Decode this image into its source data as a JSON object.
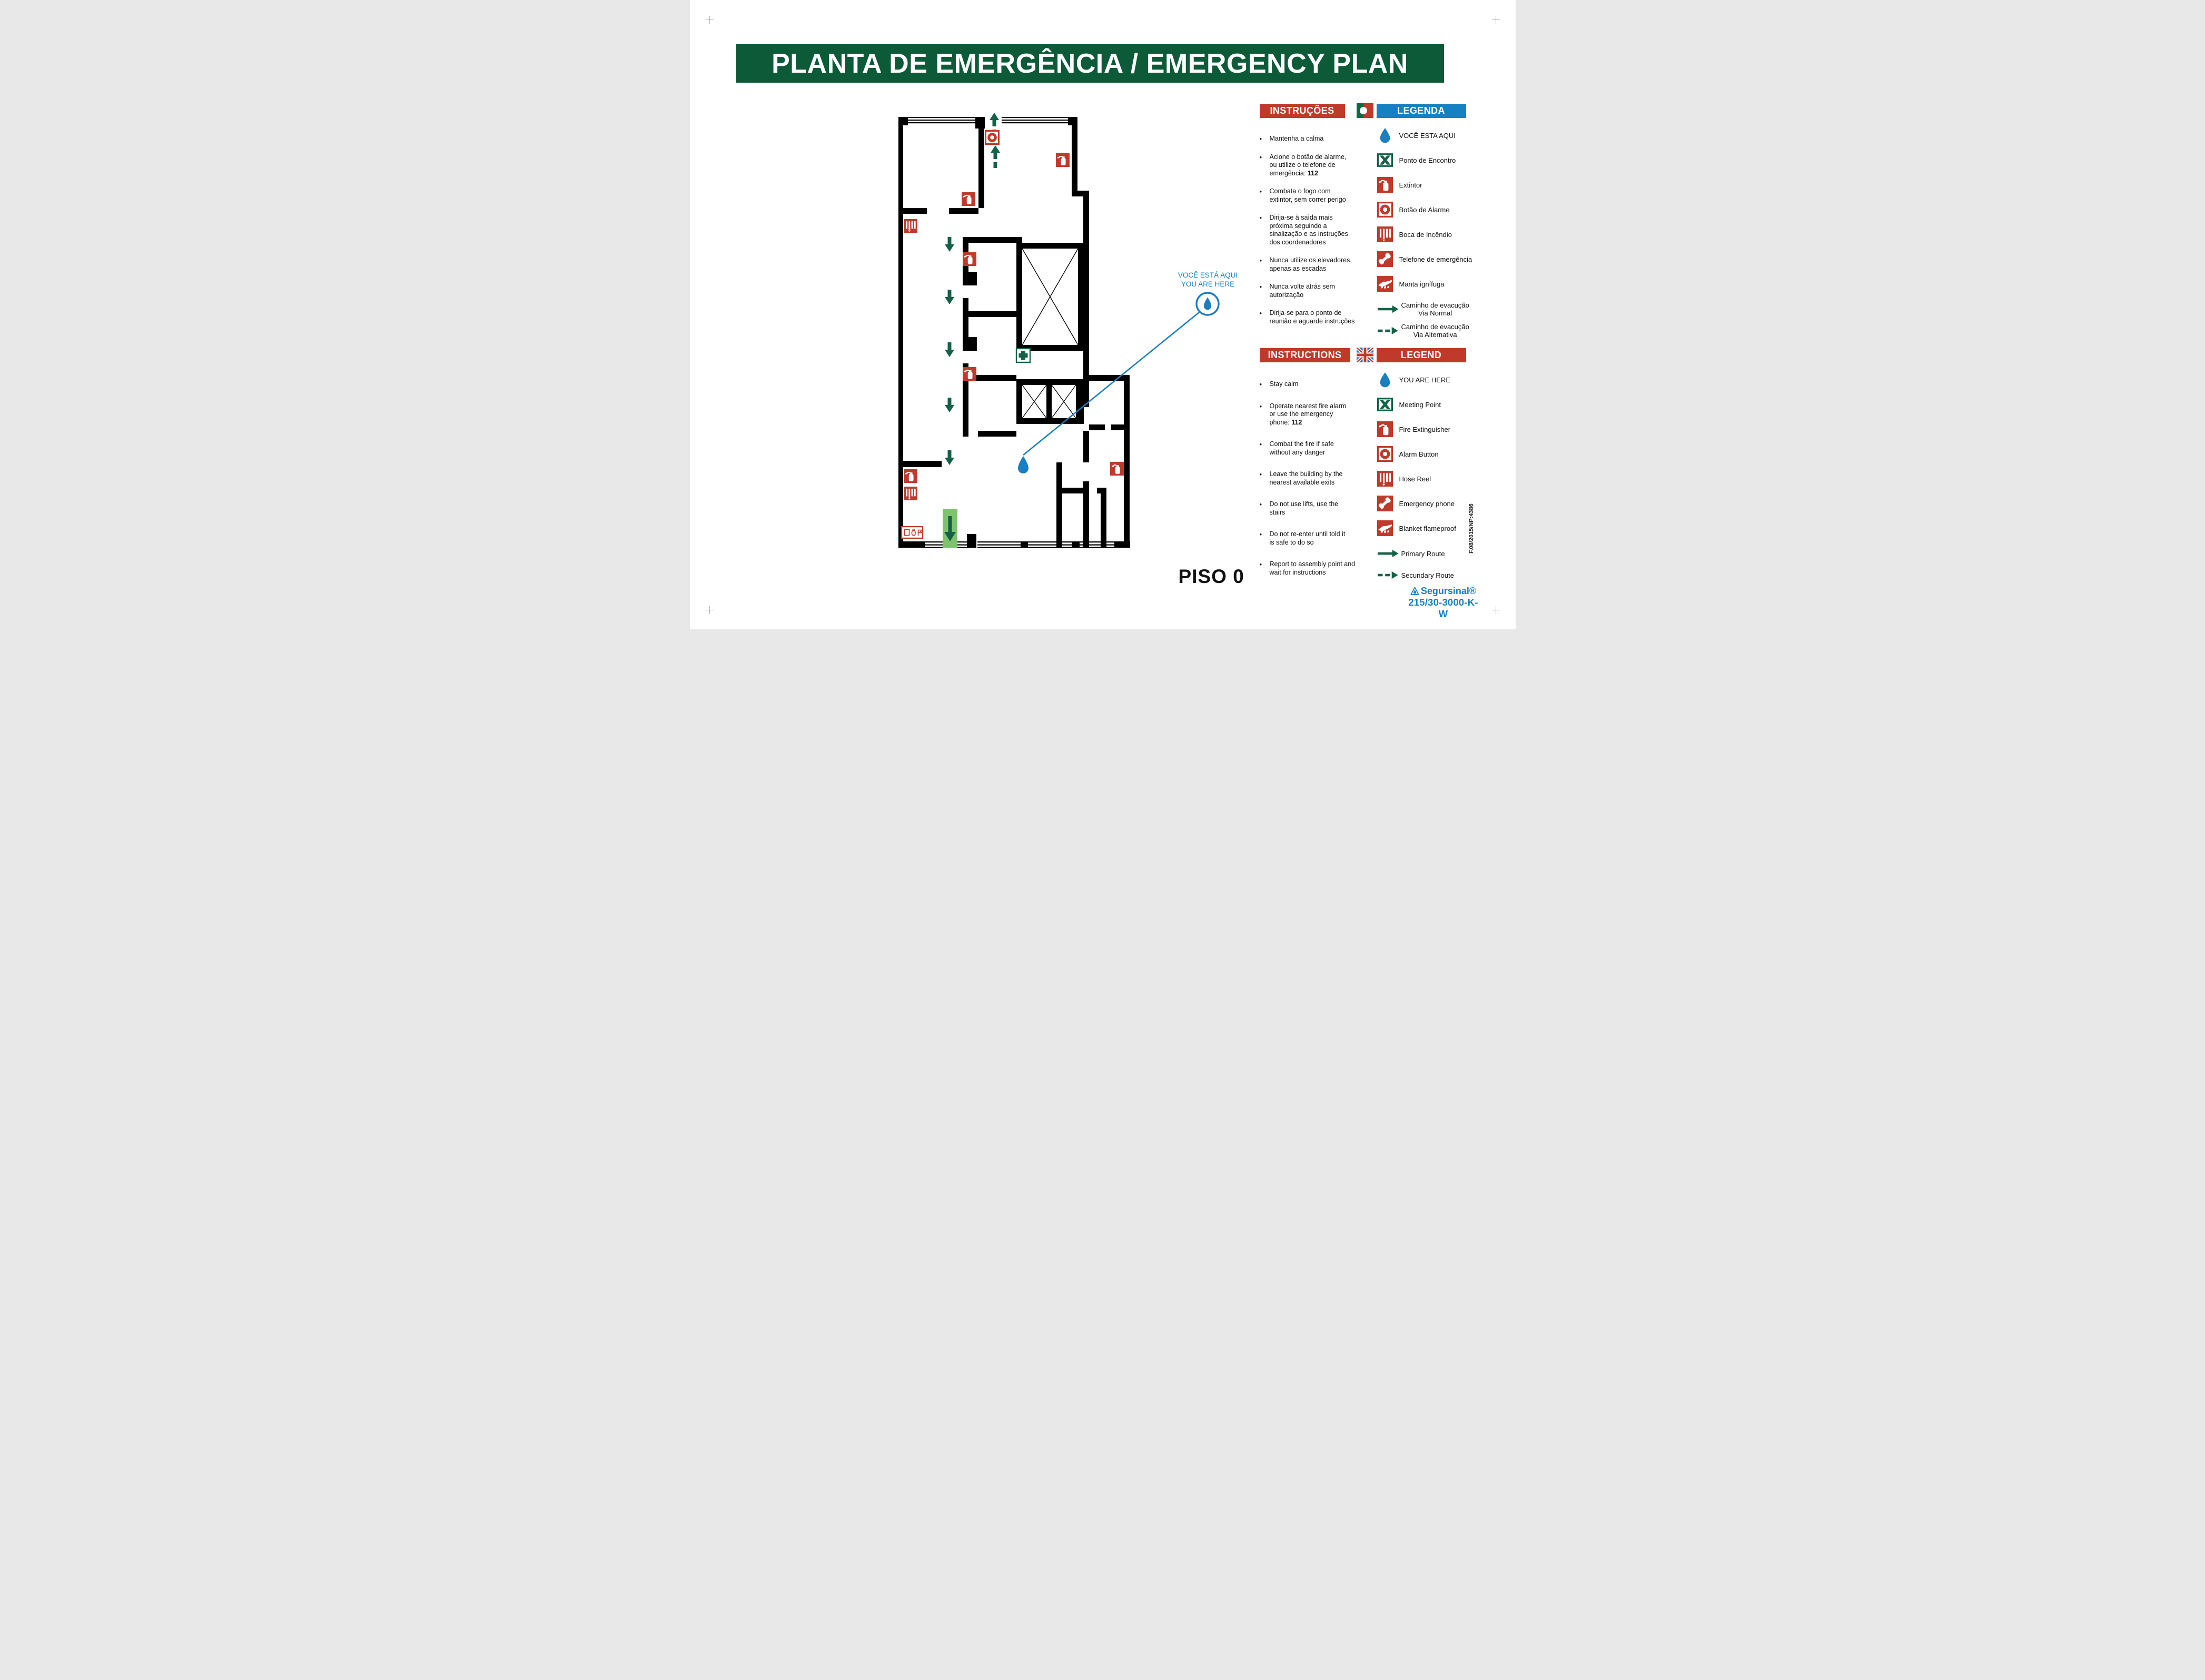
{
  "title": "PLANTA DE EMERGÊNCIA / EMERGENCY PLAN",
  "floor_label": "PISO 0",
  "callout": {
    "line1": "VOCÊ ESTÁ AQUI",
    "line2": "YOU ARE HERE"
  },
  "instructions_pt": {
    "header": "INSTRUÇÕES",
    "items": [
      "Mantenha a calma",
      "Acione o botão de alarme,\nou utilize o telefone de\nemergência: **112**",
      "Combata o fogo com\nextintor, sem correr perigo",
      "Dirija-se à saìda mais\npróxima seguindo a\nsinalização e as instruções\ndos coordenadores",
      "Nunca utilize os elevadores,\napenas as escadas",
      "Nunca volte atrás sem\nautorização",
      "Dirija-se para o ponto de\nreunião e aguarde instruções"
    ]
  },
  "legend_pt": {
    "header": "LEGENDA",
    "items": [
      {
        "icon": "icon-drop",
        "name": "you-are-here-drop-icon",
        "label": "VOCÊ ESTA AQUI"
      },
      {
        "icon": "icon-meeting",
        "name": "meeting-point-icon",
        "label": "Ponto de Encontro"
      },
      {
        "icon": "icon-ext",
        "name": "fire-extinguisher-icon",
        "label": "Extintor"
      },
      {
        "icon": "icon-alarm",
        "name": "alarm-button-icon",
        "label": "Botão de Alarme"
      },
      {
        "icon": "icon-hose",
        "name": "hose-reel-icon",
        "label": "Boca de Incêndio"
      },
      {
        "icon": "icon-phone",
        "name": "emergency-phone-icon",
        "label": "Telefone de emergência"
      },
      {
        "icon": "icon-blanket",
        "name": "fire-blanket-icon",
        "label": "Manta ignífuga"
      },
      {
        "icon": "icon-arrow-solid",
        "name": "primary-route-arrow-icon",
        "label": "Caminho de evacução\nVia Normal",
        "route": true
      },
      {
        "icon": "icon-arrow-dashed",
        "name": "secondary-route-arrow-icon",
        "label": "Caminho de evacução\nVia Alternativa",
        "route": true
      }
    ]
  },
  "instructions_en": {
    "header": "INSTRUCTIONS",
    "items": [
      "Stay calm",
      "Operate nearest fire alarm\nor use the emergency\nphone: **112**",
      "Combat the fire if safe\nwithout any danger",
      "Leave the building by the\nnearest available exits",
      "Do not use lifts, use the\nstairs",
      "Do not re-enter until told it\nis safe to do so",
      "Report to assembly point and\nwait for instructions"
    ]
  },
  "legend_en": {
    "header": "LEGEND",
    "items": [
      {
        "icon": "icon-drop",
        "name": "you-are-here-drop-icon",
        "label": "YOU ARE HERE"
      },
      {
        "icon": "icon-meeting",
        "name": "meeting-point-icon",
        "label": "Meeting Point"
      },
      {
        "icon": "icon-ext",
        "name": "fire-extinguisher-icon",
        "label": "Fire Extinguisher"
      },
      {
        "icon": "icon-alarm",
        "name": "alarm-button-icon",
        "label": "Alarm Button"
      },
      {
        "icon": "icon-hose",
        "name": "hose-reel-icon",
        "label": "Hose Reel"
      },
      {
        "icon": "icon-phone",
        "name": "emergency-phone-icon",
        "label": "Emergency phone"
      },
      {
        "icon": "icon-blanket",
        "name": "fire-blanket-icon",
        "label": "Blanket flameproof"
      },
      {
        "icon": "icon-arrow-solid",
        "name": "primary-route-arrow-icon",
        "label": "Primary Route",
        "route": true
      },
      {
        "icon": "icon-arrow-dashed",
        "name": "secondary-route-arrow-icon",
        "label": "Secundary Route",
        "route": true
      }
    ]
  },
  "footer": {
    "ref_code": "F.08/2015/NP:4386",
    "brand": "Segursinal®",
    "product_code": "215/30-3000-K-W"
  },
  "colors": {
    "banner_green": "#0d5a39",
    "header_red": "#c03a2b",
    "header_blue": "#1681c2",
    "route_green": "#136149",
    "drop_blue": "#1b7ec0",
    "exit_green": "#7dc36b"
  }
}
